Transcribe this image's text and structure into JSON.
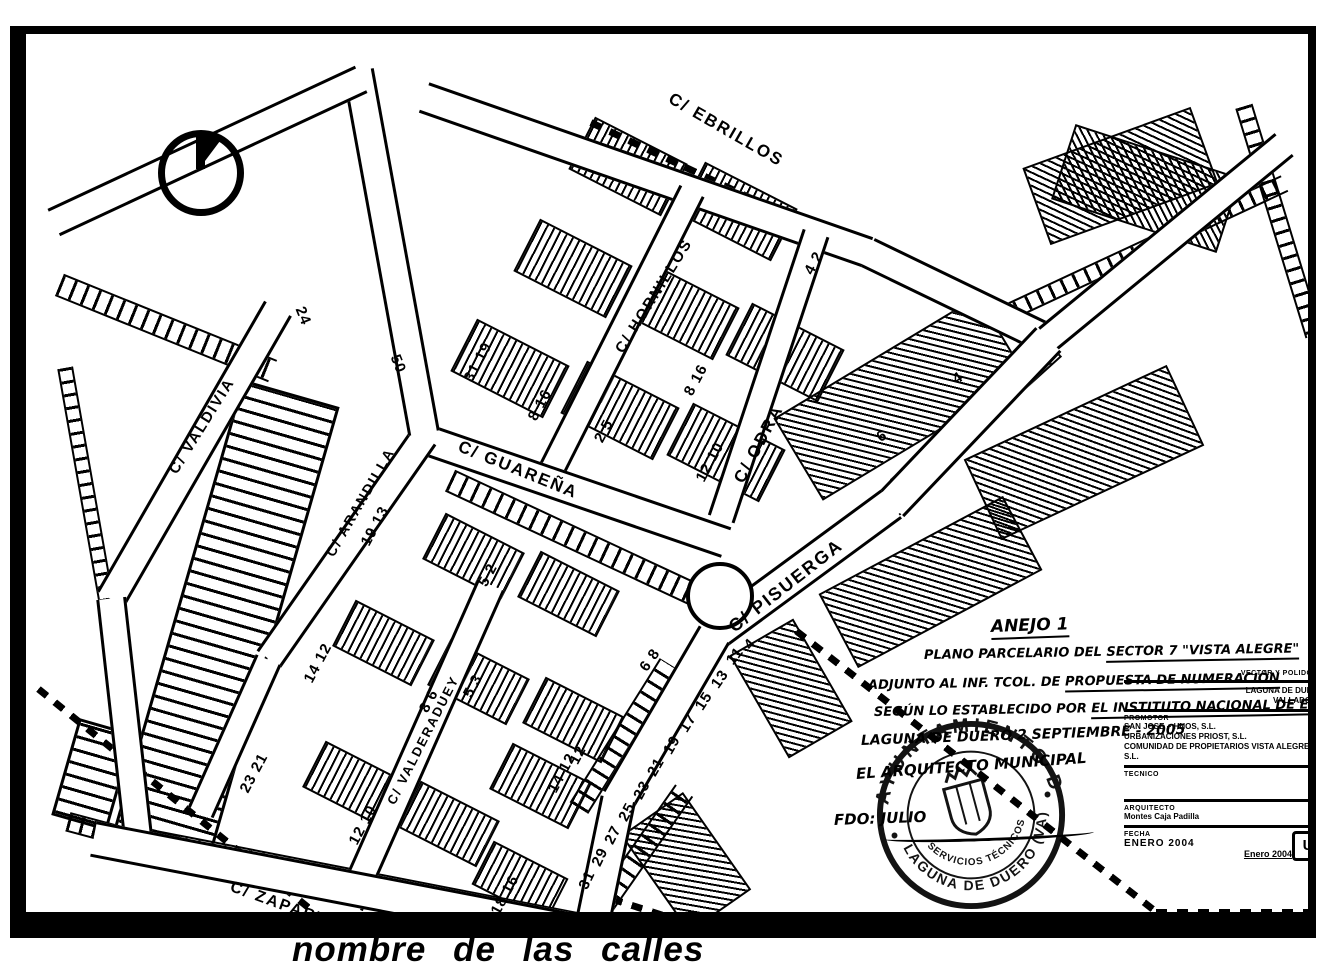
{
  "doc": {
    "caption": "nombre de las calles",
    "colors": {
      "ink": "#000000",
      "paper": "#ffffff"
    }
  },
  "map": {
    "north_icon": "north-arrow",
    "streets": [
      {
        "name": "C/ EBRILLOS",
        "x": 700,
        "y": 96,
        "r": 30,
        "fs": 17
      },
      {
        "name": "C/ HORNILLOS",
        "x": 628,
        "y": 262,
        "r": -58,
        "fs": 15
      },
      {
        "name": "C/ ODRA",
        "x": 733,
        "y": 410,
        "r": -62,
        "fs": 17
      },
      {
        "name": "C/ PISUERGA",
        "x": 760,
        "y": 552,
        "r": -38,
        "fs": 18
      },
      {
        "name": "C/ GUAREÑA",
        "x": 492,
        "y": 436,
        "r": 22,
        "fs": 17
      },
      {
        "name": "C/ ARANDILLA",
        "x": 334,
        "y": 468,
        "r": -60,
        "fs": 14
      },
      {
        "name": "C/ VALDERADUEY",
        "x": 397,
        "y": 706,
        "r": -63,
        "fs": 13
      },
      {
        "name": "C/ VALDIVIA",
        "x": 176,
        "y": 392,
        "r": -58,
        "fs": 15
      },
      {
        "name": "C/ ZAPARDIEL",
        "x": 268,
        "y": 876,
        "r": 20,
        "fs": 16
      }
    ],
    "house_numbers": [
      {
        "t": "24",
        "x": 277,
        "y": 282,
        "r": 68
      },
      {
        "t": "50",
        "x": 372,
        "y": 330,
        "r": 68
      },
      {
        "t": "31 19",
        "x": 452,
        "y": 328,
        "r": -62
      },
      {
        "t": "8 16",
        "x": 514,
        "y": 371,
        "r": -62
      },
      {
        "t": "2 5",
        "x": 578,
        "y": 397,
        "r": -62
      },
      {
        "t": "8 16",
        "x": 670,
        "y": 346,
        "r": -62
      },
      {
        "t": "12 10",
        "x": 684,
        "y": 428,
        "r": -62
      },
      {
        "t": "4 2",
        "x": 788,
        "y": 229,
        "r": -62
      },
      {
        "t": "19 13",
        "x": 349,
        "y": 492,
        "r": -62
      },
      {
        "t": "5 2",
        "x": 462,
        "y": 541,
        "r": -62
      },
      {
        "t": "14 12",
        "x": 292,
        "y": 629,
        "r": -62
      },
      {
        "t": "8 6",
        "x": 403,
        "y": 667,
        "r": -62
      },
      {
        "t": "5 3",
        "x": 447,
        "y": 652,
        "r": -62
      },
      {
        "t": "23 21",
        "x": 228,
        "y": 739,
        "r": -62
      },
      {
        "t": "12 10",
        "x": 337,
        "y": 791,
        "r": -62
      },
      {
        "t": "14 12",
        "x": 536,
        "y": 739,
        "r": -62
      },
      {
        "t": "18 16",
        "x": 479,
        "y": 861,
        "r": -62
      },
      {
        "t": "12",
        "x": 552,
        "y": 721,
        "r": -62
      },
      {
        "t": "6 8",
        "x": 624,
        "y": 626,
        "r": -55
      },
      {
        "t": "6",
        "x": 856,
        "y": 402,
        "r": -33
      },
      {
        "t": "4",
        "x": 932,
        "y": 344,
        "r": -33
      },
      {
        "t": "4",
        "x": 724,
        "y": 610,
        "r": -50
      },
      {
        "t": "11",
        "x": 709,
        "y": 622,
        "r": -52
      },
      {
        "t": "13",
        "x": 694,
        "y": 645,
        "r": -55
      },
      {
        "t": "15",
        "x": 678,
        "y": 667,
        "r": -57
      },
      {
        "t": "17",
        "x": 662,
        "y": 689,
        "r": -58
      },
      {
        "t": "19",
        "x": 646,
        "y": 711,
        "r": -60
      },
      {
        "t": "21",
        "x": 630,
        "y": 733,
        "r": -60
      },
      {
        "t": "23",
        "x": 616,
        "y": 756,
        "r": -62
      },
      {
        "t": "25",
        "x": 601,
        "y": 778,
        "r": -62
      },
      {
        "t": "27",
        "x": 587,
        "y": 801,
        "r": -63
      },
      {
        "t": "29",
        "x": 574,
        "y": 823,
        "r": -64
      },
      {
        "t": "31",
        "x": 561,
        "y": 846,
        "r": -65
      }
    ],
    "roads": [
      [
        398,
        60,
        842,
        215,
        26
      ],
      [
        842,
        215,
        1022,
        302,
        26
      ],
      [
        1022,
        302,
        1258,
        108,
        24
      ],
      [
        522,
        440,
        666,
        154,
        22
      ],
      [
        695,
        482,
        790,
        196,
        22
      ],
      [
        388,
        398,
        700,
        505,
        26
      ],
      [
        243,
        622,
        398,
        400,
        24
      ],
      [
        175,
        775,
        243,
        622,
        22
      ],
      [
        323,
        868,
        465,
        548,
        24
      ],
      [
        85,
        562,
        252,
        272,
        26
      ],
      [
        112,
        802,
        85,
        562,
        24
      ],
      [
        68,
        802,
        568,
        898,
        30
      ],
      [
        332,
        34,
        398,
        396,
        26
      ],
      [
        28,
        185,
        335,
        42,
        24
      ],
      [
        1022,
        302,
        865,
        467,
        30
      ],
      [
        865,
        467,
        688,
        597,
        30
      ],
      [
        688,
        597,
        592,
        762,
        30
      ],
      [
        592,
        762,
        566,
        888,
        30
      ]
    ],
    "ladders": [
      [
        560,
        508,
        300,
        20,
        25
      ],
      [
        140,
        292,
        230,
        20,
        22
      ],
      [
        350,
        848,
        470,
        18,
        11
      ],
      [
        950,
        382,
        210,
        20,
        -42
      ],
      [
        795,
        520,
        200,
        20,
        -35
      ],
      [
        598,
        700,
        170,
        18,
        -58
      ],
      [
        618,
        812,
        140,
        18,
        -55
      ],
      [
        1118,
        213,
        310,
        14,
        -25
      ],
      [
        1253,
        185,
        240,
        14,
        73
      ],
      [
        60,
        450,
        240,
        12,
        80
      ],
      [
        95,
        800,
        110,
        16,
        15
      ]
    ],
    "dashes": [
      [
        565,
        88,
        1012,
        300
      ],
      [
        770,
        597,
        1130,
        878
      ],
      [
        1130,
        878,
        1296,
        878
      ],
      [
        12,
        655,
        322,
        906
      ],
      [
        566,
        858,
        790,
        930
      ]
    ],
    "blocks": [
      {
        "x": 600,
        "y": 130,
        "w": 100,
        "h": 55,
        "r": 27,
        "k": "A"
      },
      {
        "x": 710,
        "y": 175,
        "w": 100,
        "h": 55,
        "r": 27,
        "k": "A"
      },
      {
        "x": 545,
        "y": 232,
        "w": 100,
        "h": 55,
        "r": 27,
        "k": "A"
      },
      {
        "x": 652,
        "y": 274,
        "w": 100,
        "h": 55,
        "r": 27,
        "k": "A"
      },
      {
        "x": 757,
        "y": 316,
        "w": 100,
        "h": 55,
        "r": 27,
        "k": "A"
      },
      {
        "x": 482,
        "y": 332,
        "w": 100,
        "h": 55,
        "r": 27,
        "k": "A"
      },
      {
        "x": 592,
        "y": 374,
        "w": 100,
        "h": 55,
        "r": 27,
        "k": "A"
      },
      {
        "x": 698,
        "y": 416,
        "w": 100,
        "h": 55,
        "r": 27,
        "k": "A"
      },
      {
        "x": 445,
        "y": 520,
        "w": 85,
        "h": 48,
        "r": 27,
        "k": "A"
      },
      {
        "x": 540,
        "y": 558,
        "w": 85,
        "h": 48,
        "r": 27,
        "k": "A"
      },
      {
        "x": 355,
        "y": 607,
        "w": 85,
        "h": 48,
        "r": 27,
        "k": "A"
      },
      {
        "x": 450,
        "y": 646,
        "w": 85,
        "h": 48,
        "r": 27,
        "k": "A"
      },
      {
        "x": 545,
        "y": 684,
        "w": 85,
        "h": 48,
        "r": 27,
        "k": "A"
      },
      {
        "x": 325,
        "y": 748,
        "w": 85,
        "h": 48,
        "r": 27,
        "k": "A"
      },
      {
        "x": 420,
        "y": 788,
        "w": 85,
        "h": 48,
        "r": 27,
        "k": "A"
      },
      {
        "x": 512,
        "y": 750,
        "w": 85,
        "h": 48,
        "r": 27,
        "k": "A"
      },
      {
        "x": 492,
        "y": 845,
        "w": 80,
        "h": 45,
        "r": 27,
        "k": "A"
      },
      {
        "x": 196,
        "y": 585,
        "w": 95,
        "h": 470,
        "r": 16,
        "k": "C"
      },
      {
        "x": 64,
        "y": 737,
        "w": 52,
        "h": 95,
        "r": 16,
        "k": "C"
      },
      {
        "x": 872,
        "y": 362,
        "w": 235,
        "h": 92,
        "r": -31,
        "k": "B"
      },
      {
        "x": 1056,
        "y": 416,
        "w": 220,
        "h": 85,
        "r": -25,
        "k": "B"
      },
      {
        "x": 902,
        "y": 546,
        "w": 205,
        "h": 80,
        "r": -28,
        "k": "B"
      },
      {
        "x": 1092,
        "y": 140,
        "w": 175,
        "h": 78,
        "r": -20,
        "k": "B"
      },
      {
        "x": 1118,
        "y": 152,
        "w": 170,
        "h": 75,
        "r": 18,
        "k": "B"
      },
      {
        "x": 763,
        "y": 652,
        "w": 70,
        "h": 115,
        "r": -30,
        "k": "B"
      },
      {
        "x": 658,
        "y": 826,
        "w": 72,
        "h": 115,
        "r": -35,
        "k": "B"
      }
    ],
    "bulb": {
      "x": 690,
      "y": 558,
      "rad": 30
    },
    "annotations": {
      "anejo": "ANEJO 1",
      "line1a": "PLANO PARCELARIO DEL",
      "line1b": "SECTOR 7 \"VISTA ALEGRE\"",
      "line2a": "ADJUNTO AL INF. TCOL. DE",
      "line2b": "PROPUESTA DE NUMERACIÓN",
      "line3a": "SEGÚN LO ESTABLECIDO POR",
      "line3b": "EL INSTITUTO NACIONAL DE EST.",
      "line4": "LAGUNA DE DUERO 2 SEPTIEMBRE - 2005",
      "line5": "EL ARQUITECTO MUNICIPAL",
      "line6": "FDO: JULIO"
    },
    "stamp": {
      "outer_top": "AYUNTAMIENTO DE",
      "outer_bottom": "LAGUNA DE DUERO (VA)",
      "inner": "SERVICIOS TÉCNICOS"
    },
    "titleblock": {
      "small1": "VECTOR Y POLIDORO",
      "loc1": "LAGUNA DE DUERO",
      "loc2": "VALLADOLID",
      "promotor_label": "PROMOTOR",
      "comp1": "SAN JOSE + HNOS, S.L.",
      "comp2": "URBANIZACIONES PRIOST, S.L.",
      "comp3": "COMUNIDAD DE PROPIETARIOS VISTA ALEGRE, S.L.",
      "tecnico_label": "TECNICO",
      "arq_label": "ARQUITECTO",
      "arq_name": "Montes Caja Padilla",
      "logo": "U",
      "fecha_label": "FECHA",
      "fecha1": "ENERO 2004",
      "fecha2": "Enero 2004"
    }
  }
}
